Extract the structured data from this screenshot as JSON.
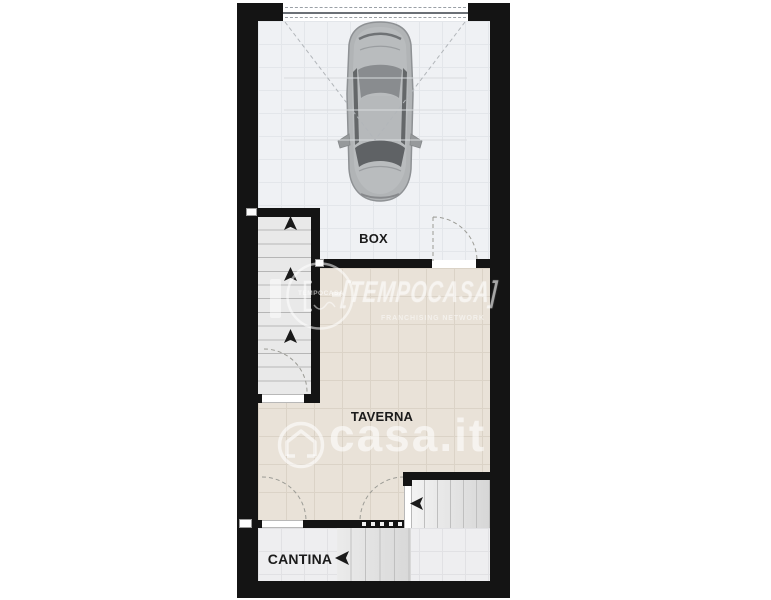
{
  "floorplan": {
    "rooms": [
      {
        "id": "box",
        "label": "BOX"
      },
      {
        "id": "taverna",
        "label": "TAVERNA"
      },
      {
        "id": "cantina",
        "label": "CANTINA"
      }
    ],
    "colors": {
      "wall": "#141414",
      "box_floor": "#eff1f4",
      "taverna_floor": "#e9e2d8",
      "cantina_floor": "#eeeef0",
      "stair_floor": "#e9e9e9",
      "background": "#ffffff"
    }
  },
  "watermarks": {
    "tempocasa": {
      "wordmark": "[TEMPOCASA]",
      "subtitle": "FRANCHISING NETWORK",
      "stamp_text": "TEMPOCASA"
    },
    "casait": {
      "text": "casa.it"
    }
  }
}
